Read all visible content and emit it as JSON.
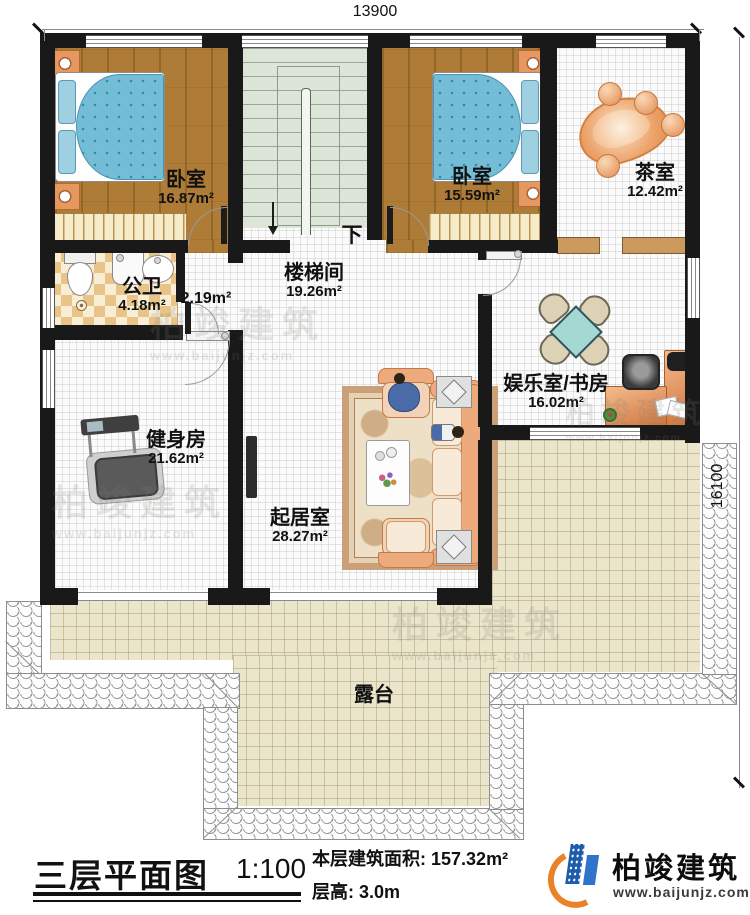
{
  "dimensions": {
    "width_top": "13900",
    "height_right": "16100"
  },
  "stairs": {
    "direction_label": "下"
  },
  "rooms": {
    "bedroom1": {
      "name": "卧室",
      "area": "16.87m²"
    },
    "bedroom2": {
      "name": "卧室",
      "area": "15.59m²"
    },
    "tea_room": {
      "name": "茶室",
      "area": "12.42m²"
    },
    "bathroom": {
      "name": "公卫",
      "area": "4.18m²"
    },
    "vestibule": {
      "area": "2.19m²"
    },
    "stair_hall": {
      "name": "楼梯间",
      "area": "19.26m²"
    },
    "gym": {
      "name": "健身房",
      "area": "21.62m²"
    },
    "living_room": {
      "name": "起居室",
      "area": "28.27m²"
    },
    "study": {
      "name": "娱乐室/书房",
      "area": "16.02m²"
    },
    "terrace": {
      "name": "露台"
    }
  },
  "title_block": {
    "drawing_title": "三层平面图",
    "scale": "1:100",
    "area_label": "本层建筑面积:",
    "area_value": "157.32m²",
    "height_label": "层高:",
    "height_value": "3.0m"
  },
  "brand": {
    "name": "柏竣建筑",
    "website": "www.baijunjz.com"
  },
  "watermark": {
    "name": "柏竣建筑",
    "website": "www.baijunjz.com"
  },
  "colors": {
    "wall": "#191919",
    "wood": "#ae7c36",
    "bed": "#73bdd7",
    "stairs": "#dde4d8",
    "terrace": "#ebe5cc",
    "logo_blue": "#1c5cab",
    "logo_orange": "#e8832a"
  }
}
